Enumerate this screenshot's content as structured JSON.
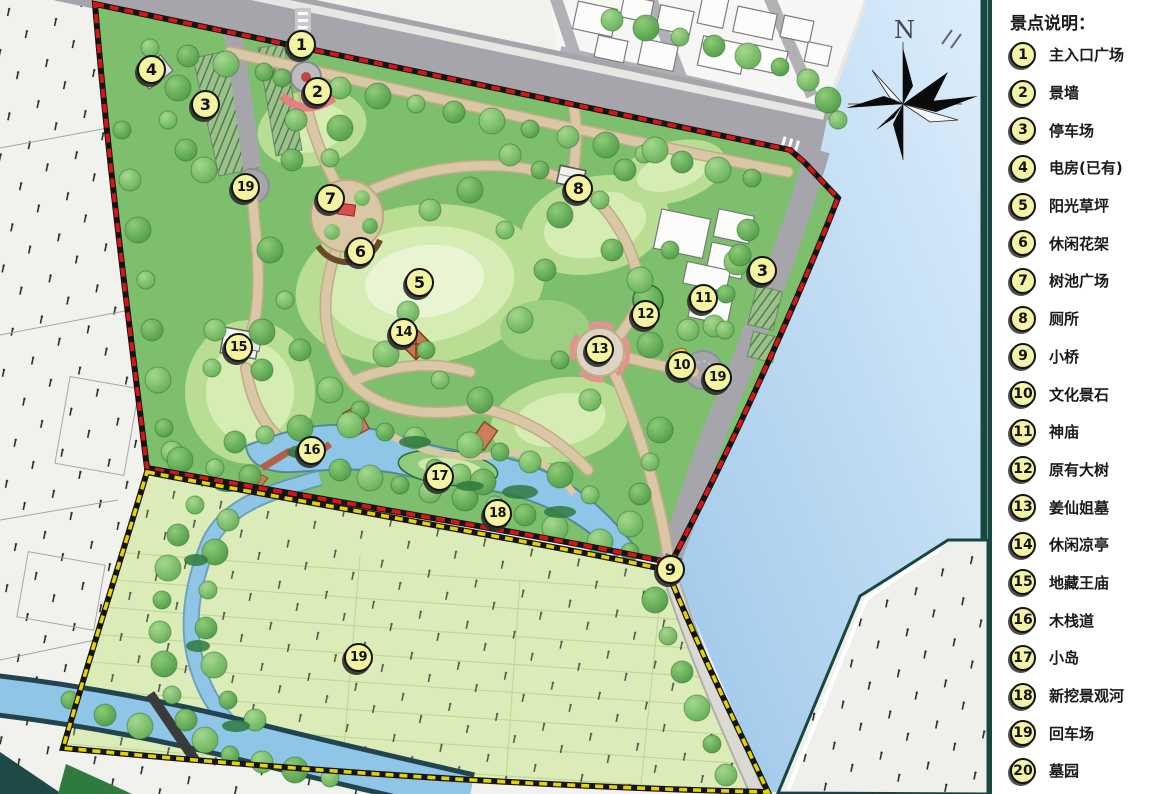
{
  "legend": {
    "title": "景点说明：",
    "items": [
      {
        "num": "1",
        "label": "主入口广场"
      },
      {
        "num": "2",
        "label": "景墙"
      },
      {
        "num": "3",
        "label": "停车场"
      },
      {
        "num": "4",
        "label": "电房(已有)"
      },
      {
        "num": "5",
        "label": "阳光草坪"
      },
      {
        "num": "6",
        "label": "休闲花架"
      },
      {
        "num": "7",
        "label": "树池广场"
      },
      {
        "num": "8",
        "label": "厕所"
      },
      {
        "num": "9",
        "label": "小桥"
      },
      {
        "num": "10",
        "label": "文化景石"
      },
      {
        "num": "11",
        "label": "神庙"
      },
      {
        "num": "12",
        "label": "原有大树"
      },
      {
        "num": "13",
        "label": "姜仙姐墓"
      },
      {
        "num": "14",
        "label": "休闲凉亭"
      },
      {
        "num": "15",
        "label": "地藏王庙"
      },
      {
        "num": "16",
        "label": "木栈道"
      },
      {
        "num": "17",
        "label": "小岛"
      },
      {
        "num": "18",
        "label": "新挖景观河"
      },
      {
        "num": "19",
        "label": "回车场"
      },
      {
        "num": "20",
        "label": "墓园"
      }
    ]
  },
  "map": {
    "compass_label": "N",
    "markers": [
      {
        "num": "1",
        "x": 302,
        "y": 45
      },
      {
        "num": "2",
        "x": 318,
        "y": 92
      },
      {
        "num": "3",
        "x": 206,
        "y": 105
      },
      {
        "num": "4",
        "x": 152,
        "y": 70
      },
      {
        "num": "19",
        "x": 246,
        "y": 188
      },
      {
        "num": "7",
        "x": 331,
        "y": 199
      },
      {
        "num": "6",
        "x": 361,
        "y": 252
      },
      {
        "num": "5",
        "x": 420,
        "y": 283
      },
      {
        "num": "8",
        "x": 579,
        "y": 189
      },
      {
        "num": "14",
        "x": 404,
        "y": 333
      },
      {
        "num": "15",
        "x": 239,
        "y": 348
      },
      {
        "num": "3",
        "x": 763,
        "y": 271
      },
      {
        "num": "11",
        "x": 704,
        "y": 299
      },
      {
        "num": "12",
        "x": 646,
        "y": 315
      },
      {
        "num": "13",
        "x": 600,
        "y": 350
      },
      {
        "num": "10",
        "x": 682,
        "y": 366
      },
      {
        "num": "19",
        "x": 718,
        "y": 378
      },
      {
        "num": "16",
        "x": 312,
        "y": 451
      },
      {
        "num": "17",
        "x": 440,
        "y": 477
      },
      {
        "num": "18",
        "x": 498,
        "y": 514
      },
      {
        "num": "9",
        "x": 671,
        "y": 570
      },
      {
        "num": "19",
        "x": 359,
        "y": 658
      }
    ]
  },
  "colors": {
    "park_green": "#7ebf6e",
    "lawn_light": "#d5ecb2",
    "cemetery_green": "#dcecb8",
    "water_blue": "#aacfec",
    "lake_blue": "#8fc6e8",
    "road_gray": "#a5a5ab",
    "path_tan": "#d9c7a6",
    "boundary_red": "#d81414",
    "boundary_yellow": "#e6d200",
    "marker_yellow": "#f3f3a0",
    "embankment_teal": "#17473f"
  }
}
